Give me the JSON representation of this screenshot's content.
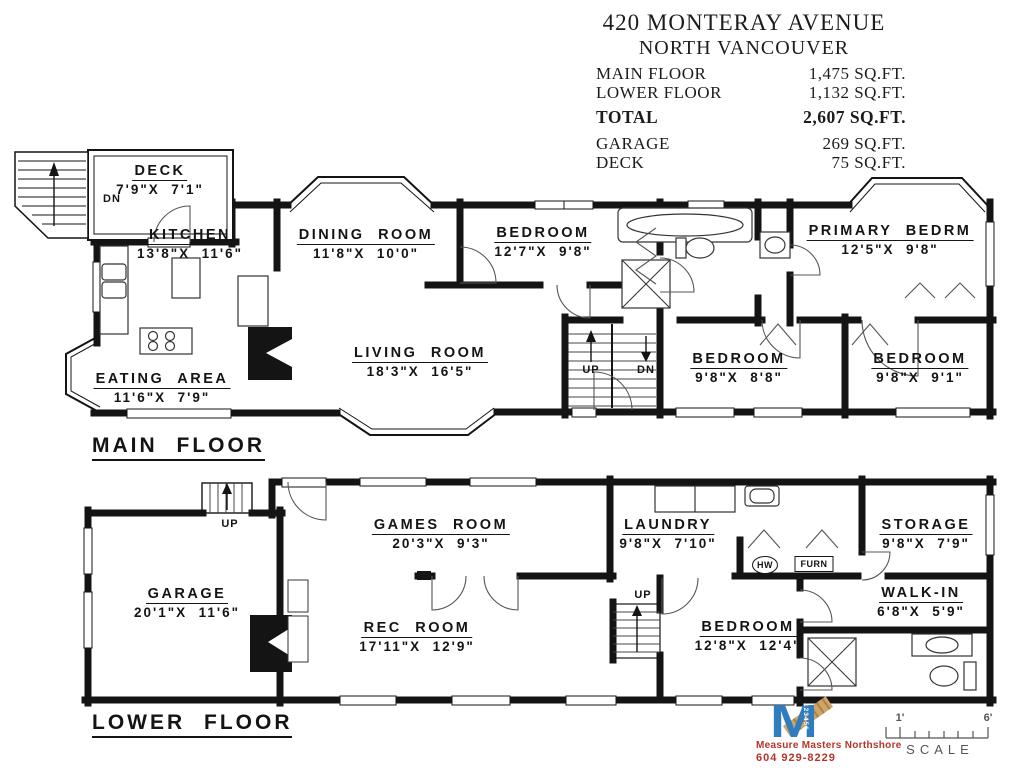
{
  "title_block": {
    "address_line1": "420 MONTERAY AVENUE",
    "address_line2": "NORTH VANCOUVER",
    "rows": [
      {
        "label": "MAIN FLOOR",
        "value": "1,475 SQ.FT."
      },
      {
        "label": "LOWER FLOOR",
        "value": "1,132 SQ.FT."
      },
      {
        "label": "TOTAL",
        "value": "2,607 SQ.FT."
      },
      {
        "label": "GARAGE",
        "value": "269 SQ.FT."
      },
      {
        "label": "DECK",
        "value": "75 SQ.FT."
      }
    ]
  },
  "main_floor": {
    "title": "MAIN FLOOR",
    "rooms": [
      {
        "name": "DECK",
        "dims": "7'9\"X  7'1\""
      },
      {
        "name": "KITCHEN",
        "dims": "13'8\"X  11'6\""
      },
      {
        "name": "DINING ROOM",
        "dims": "11'8\"X  10'0\""
      },
      {
        "name": "BEDROOM",
        "dims": "12'7\"X  9'8\""
      },
      {
        "name": "PRIMARY BEDRM",
        "dims": "12'5\"X  9'8\""
      },
      {
        "name": "LIVING ROOM",
        "dims": "18'3\"X  16'5\""
      },
      {
        "name": "EATING AREA",
        "dims": "11'6\"X  7'9\""
      },
      {
        "name": "BEDROOM",
        "dims": "9'8\"X  8'8\""
      },
      {
        "name": "BEDROOM",
        "dims": "9'8\"X  9'1\""
      }
    ],
    "labels": {
      "deck_dn": "DN",
      "stair_up": "UP",
      "stair_dn": "DN"
    }
  },
  "lower_floor": {
    "title": "LOWER FLOOR",
    "rooms": [
      {
        "name": "GAMES ROOM",
        "dims": "20'3\"X  9'3\""
      },
      {
        "name": "LAUNDRY",
        "dims": "9'8\"X  7'10\""
      },
      {
        "name": "STORAGE",
        "dims": "9'8\"X  7'9\""
      },
      {
        "name": "GARAGE",
        "dims": "20'1\"X  11'6\""
      },
      {
        "name": "REC ROOM",
        "dims": "17'11\"X  12'9\""
      },
      {
        "name": "BEDROOM",
        "dims": "12'8\"X  12'4\""
      },
      {
        "name": "WALK-IN",
        "dims": "6'8\"X  5'9\""
      }
    ],
    "labels": {
      "entry_up": "UP",
      "mid_up": "UP",
      "hw": "HW",
      "furnace": "FURN"
    }
  },
  "footer": {
    "logo_letter": "M",
    "logo_digits": "123456",
    "company_line1": "Measure Masters Northshore",
    "company_line2": "604 929-8229",
    "scale_left": "1'",
    "scale_right": "6'",
    "scale_label": "SCALE",
    "colors": {
      "brand_blue": "#2f7dbe",
      "brand_gold": "#cfa468",
      "brand_red": "#b5342a",
      "ink": "#141414"
    }
  }
}
